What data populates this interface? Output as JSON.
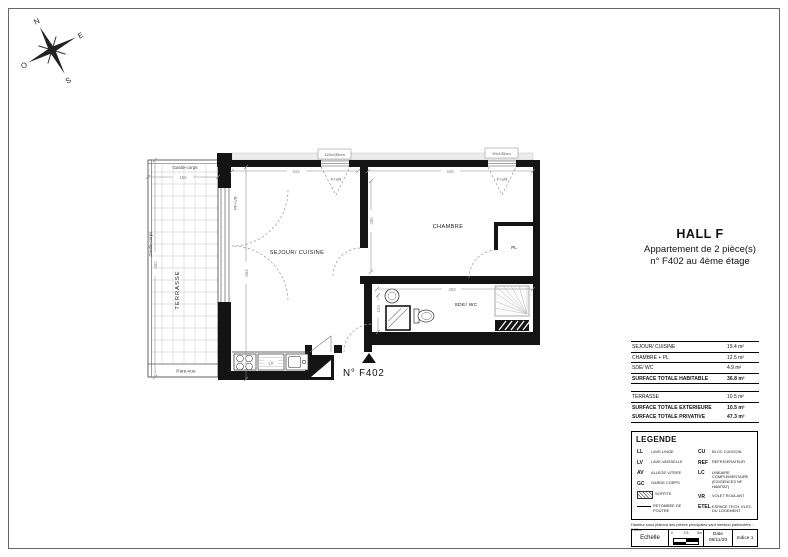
{
  "sheet": {
    "title": "HALL F",
    "subtitle1": "Appartement de 2 pièce(s)",
    "subtitle2": "n° F402 au 4ème étage"
  },
  "compass": {
    "n": "N",
    "e": "E",
    "s": "S",
    "w": "O"
  },
  "plan": {
    "unit_number": "N° F402",
    "rooms": {
      "terrasse": "TERRASSE",
      "sejour": "SEJOUR/ CUISINE",
      "chambre": "CHAMBRE",
      "sde": "SDE/ WC",
      "pl": "PL"
    },
    "labels": {
      "garde_corps_top": "Garde-corps",
      "garde_corps_left": "Garde-corps",
      "pare_vue": "Pare-vue",
      "window1": "F+VR",
      "window2": "F+VR",
      "door_window": "PF+VR",
      "dishwasher": "LV",
      "window1_size": "120x135cm",
      "window2_size": "90x135cm"
    },
    "dimensions": {
      "terrasse_width": "186",
      "terrasse_height": "582",
      "sejour_width": "344",
      "sejour_height": "564",
      "chambre_width": "446",
      "chambre_height": "280",
      "sde_width": "369",
      "sde_height": "133"
    }
  },
  "surface_table": {
    "rows": [
      {
        "label": "SEJOUR/ CUISINE",
        "value": "19.4 m²"
      },
      {
        "label": "CHAMBRE + PL",
        "value": "12.5 m²"
      },
      {
        "label": "SDE/ WC",
        "value": "4.9 m²"
      }
    ],
    "total_habitable": {
      "label": "SURFACE TOTALE HABITABLE",
      "value": "36.8 m²"
    },
    "terrasse_row": {
      "label": "TERRASSE",
      "value": "10.5 m²"
    },
    "total_exterieure": {
      "label": "SURFACE TOTALE EXTERIEURE",
      "value": "10.5 m²"
    },
    "total_privative": {
      "label": "SURFACE TOTALE PRIVATIVE",
      "value": "47.3 m²"
    }
  },
  "legend": {
    "title": "LEGENDE",
    "left": [
      {
        "abbr": "LL",
        "label": "LAVE-LINGE"
      },
      {
        "abbr": "LV",
        "label": "LAVE-VAISSELLE"
      },
      {
        "abbr": "AV",
        "label": "ALLEGE VITREE"
      },
      {
        "abbr": "GC",
        "label": "GARDE CORPS"
      },
      {
        "abbr": "",
        "label": "SOFFITE"
      },
      {
        "abbr": "",
        "label": "RETOMBEE DE POUTRE"
      }
    ],
    "right": [
      {
        "abbr": "CU",
        "label": "BLOC CUISSON"
      },
      {
        "abbr": "REF",
        "label": "REFRIGERATEUR"
      },
      {
        "abbr": "LC",
        "label": "LINEAIRE COMPLEMENTAIRE (EXIGENCES NF HABITAT)"
      },
      {
        "abbr": "VR",
        "label": "VOLET ROULANT"
      },
      {
        "abbr": "ETEL",
        "label": "ESPACE TECH. ELEC. DU LOGEMENT"
      }
    ],
    "note": "Hauteur sous plafond des pièces principales sauf mention particulière : 2.50m"
  },
  "titleblock": {
    "scale_label": "Echelle",
    "scale_ticks": [
      "0",
      "2.5",
      "5m"
    ],
    "date_label": "Date",
    "date_value": "09/11/20",
    "index_label": "Indice 1"
  }
}
